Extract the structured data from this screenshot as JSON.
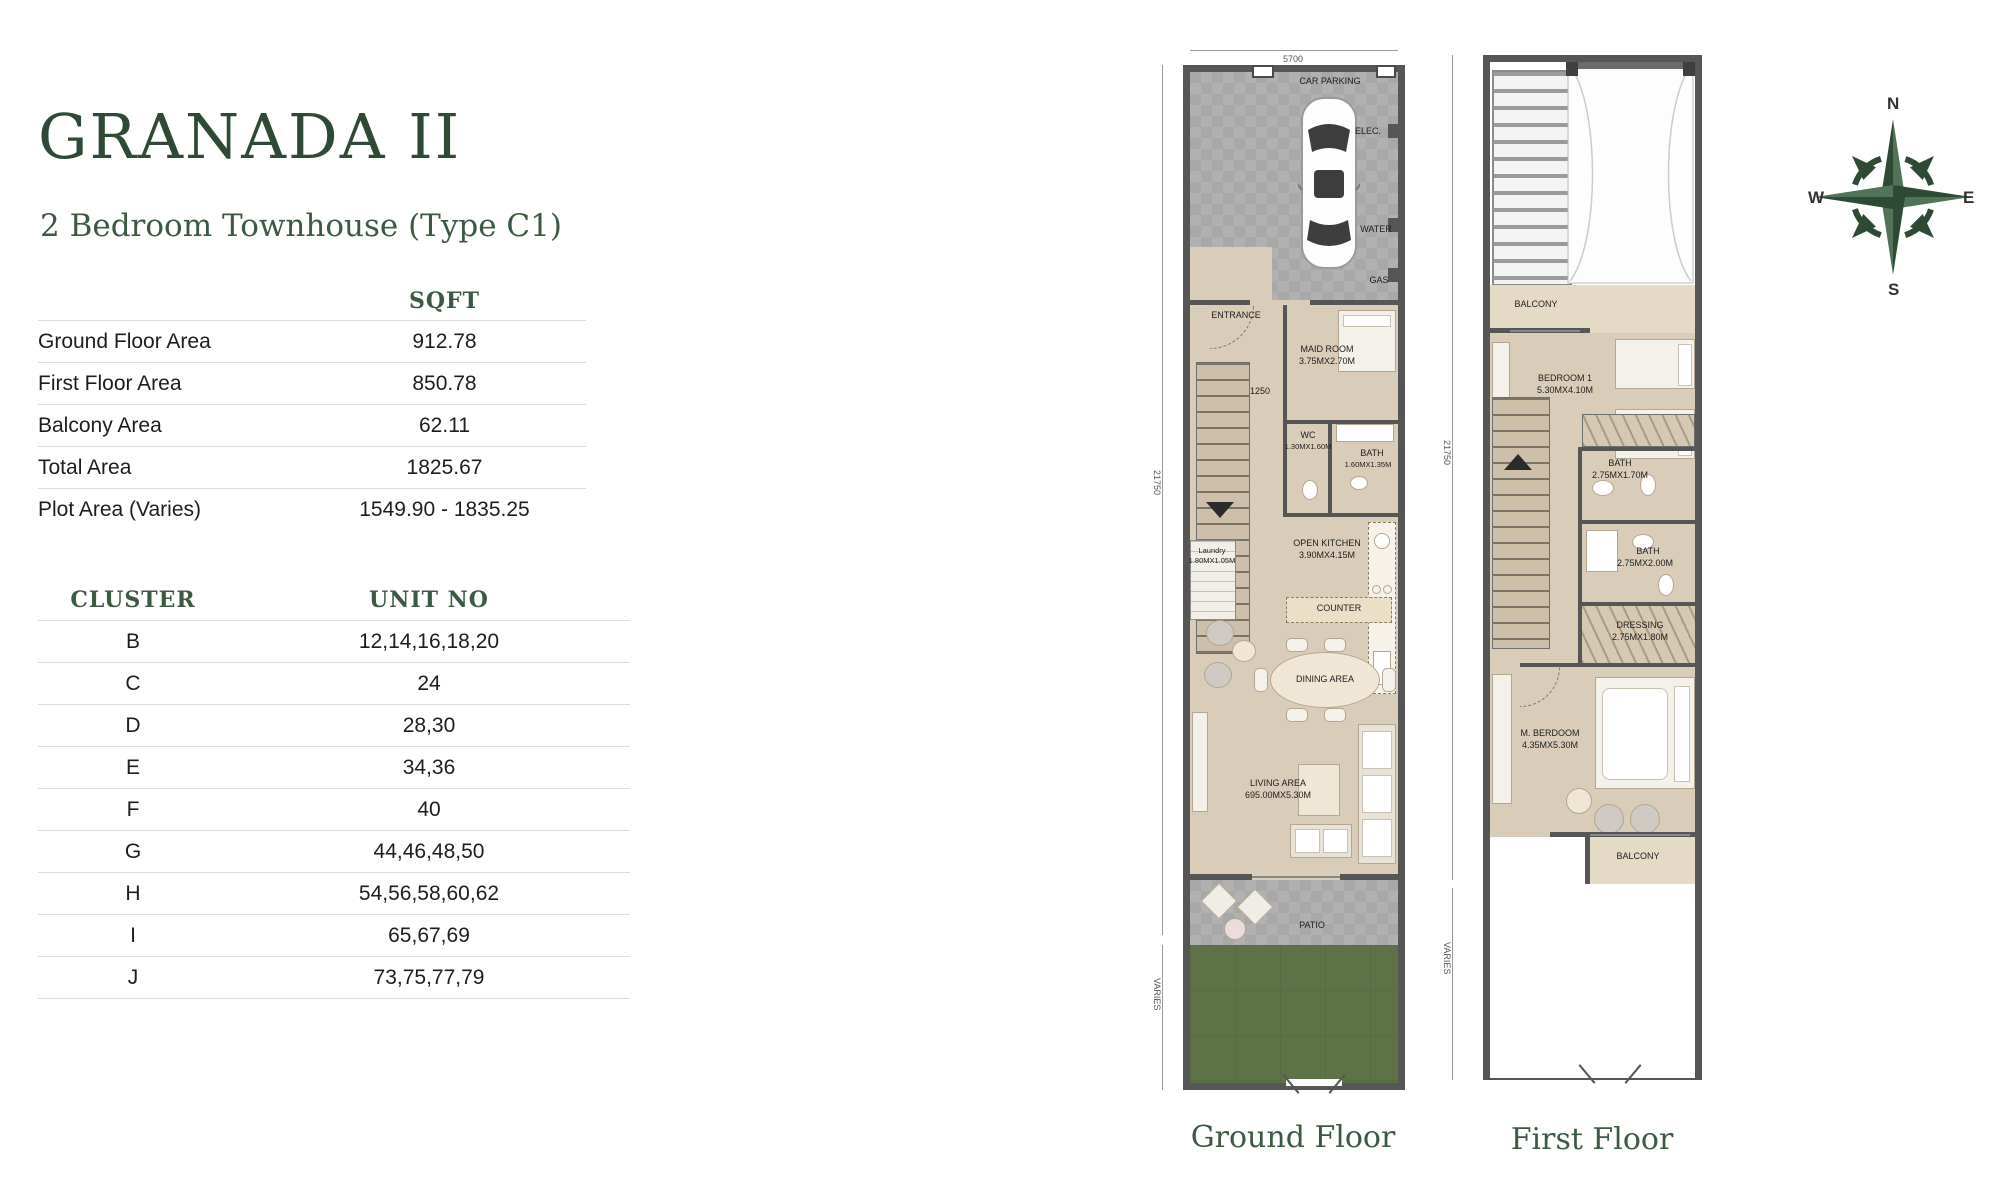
{
  "header": {
    "title": "GRANADA II",
    "subtitle": "2 Bedroom Townhouse (Type C1)"
  },
  "area_table": {
    "header": "SQFT",
    "rows": [
      {
        "label": "Ground Floor Area",
        "value": "912.78"
      },
      {
        "label": "First Floor Area",
        "value": "850.78"
      },
      {
        "label": "Balcony Area",
        "value": "62.11"
      },
      {
        "label": "Total Area",
        "value": "1825.67"
      },
      {
        "label": "Plot Area (Varies)",
        "value": "1549.90 - 1835.25"
      }
    ]
  },
  "cluster_table": {
    "col1": "CLUSTER",
    "col2": "UNIT NO",
    "rows": [
      {
        "cluster": "B",
        "units": "12,14,16,18,20"
      },
      {
        "cluster": "C",
        "units": "24"
      },
      {
        "cluster": "D",
        "units": "28,30"
      },
      {
        "cluster": "E",
        "units": "34,36"
      },
      {
        "cluster": "F",
        "units": "40"
      },
      {
        "cluster": "G",
        "units": "44,46,48,50"
      },
      {
        "cluster": "H",
        "units": "54,56,58,60,62"
      },
      {
        "cluster": "I",
        "units": "65,67,69"
      },
      {
        "cluster": "J",
        "units": "73,75,77,79"
      }
    ]
  },
  "ground_floor": {
    "caption": "Ground Floor",
    "dims": {
      "top": "5700",
      "side": "21750",
      "side_bottom": "VARIES"
    },
    "rooms": {
      "car_parking": "CAR PARKING",
      "elec": "ELEC.",
      "water": "WATER",
      "gas": "GAS",
      "entrance": "ENTRANCE",
      "maid_room": "MAID ROOM",
      "maid_room_dim": "3.75MX2.70M",
      "hall_dim": "1250",
      "wc": "WC",
      "wc_dim": "1.30MX1.60M",
      "bath": "BATH",
      "bath_dim": "1.60MX1.35M",
      "laundry": "Laundry",
      "laundry_dim": "1.80MX1.05M",
      "open_kitchen": "OPEN KITCHEN",
      "open_kitchen_dim": "3.90MX4.15M",
      "counter": "COUNTER",
      "dining": "DINING AREA",
      "living": "LIVING AREA",
      "living_dim": "695.00MX5.30M",
      "patio": "PATIO"
    }
  },
  "first_floor": {
    "caption": "First Floor",
    "dims": {
      "side": "21750",
      "side_bottom": "VARIES"
    },
    "rooms": {
      "balcony_top": "BALCONY",
      "bedroom1": "BEDROOM 1",
      "bedroom1_dim": "5.30MX4.10M",
      "bath1": "BATH",
      "bath1_dim": "2.75MX1.70M",
      "bath2": "BATH",
      "bath2_dim": "2.75MX2.00M",
      "dressing": "DRESSING",
      "dressing_dim": "2.75MX1.80M",
      "master_bedroom": "M. BERDOOM",
      "master_bedroom_dim": "4.35MX5.30M",
      "balcony_bottom": "BALCONY"
    }
  },
  "compass": {
    "n": "N",
    "e": "E",
    "s": "S",
    "w": "W"
  },
  "colors": {
    "accent_green": "#2e4a34",
    "garden_green": "#5d7347",
    "floor_beige": "#d9cdb9",
    "wall_gray": "#565656",
    "parking_gray": "#a8a8a8"
  }
}
